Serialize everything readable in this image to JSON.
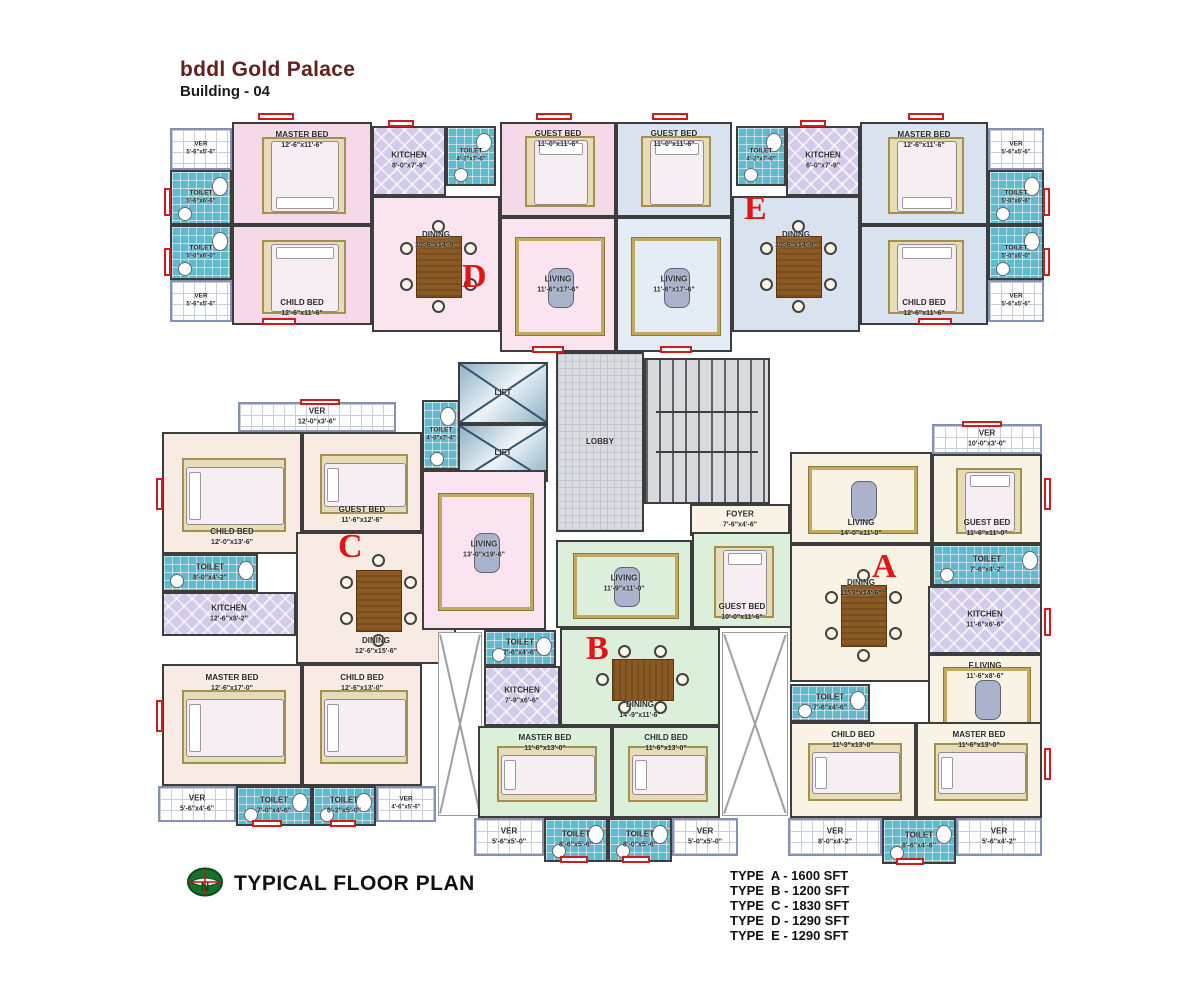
{
  "header": {
    "title": "bddl Gold Palace",
    "subtitle": "Building - 04"
  },
  "footer": {
    "plan_label": "TYPICAL FLOOR PLAN",
    "logo": "compass-north-icon",
    "types": [
      "TYPE  A - 1600 SFT",
      "TYPE  B - 1200 SFT",
      "TYPE  C - 1830 SFT",
      "TYPE  D - 1290 SFT",
      "TYPE  E - 1290 SFT"
    ]
  },
  "colors": {
    "unit_d": "#f6d9e9",
    "unit_e": "#d9e3ef",
    "unit_b": "#dcefdb",
    "unit_a": "#f8f3e4",
    "unit_c": "#f8ebe4",
    "toilet_tile": "#5fbac9",
    "kitchen_tile": "#d2cbe9",
    "letter_red": "#e01515",
    "title_maroon": "#63201c",
    "window_red": "#cf1d1d"
  },
  "unit_letters": [
    {
      "letter": "D",
      "x": 462,
      "y": 258
    },
    {
      "letter": "E",
      "x": 744,
      "y": 190
    },
    {
      "letter": "C",
      "x": 338,
      "y": 528
    },
    {
      "letter": "B",
      "x": 586,
      "y": 630
    },
    {
      "letter": "A",
      "x": 872,
      "y": 548
    }
  ],
  "rooms": [
    {
      "id": "ver-d-top",
      "type": "ver",
      "name": "VER",
      "dims": "5'-6\"x5'-6\"",
      "x": 170,
      "y": 128,
      "w": 62,
      "h": 42
    },
    {
      "id": "toilet-d-1",
      "type": "toilet",
      "name": "TOILET",
      "dims": "5'-6\"x6'-6\"",
      "x": 170,
      "y": 170,
      "w": 62,
      "h": 55,
      "furn": [
        "wc"
      ]
    },
    {
      "id": "toilet-d-2",
      "type": "toilet",
      "name": "TOILET",
      "dims": "5'-0\"x6'-0\"",
      "x": 170,
      "y": 225,
      "w": 62,
      "h": 55,
      "furn": [
        "wc"
      ]
    },
    {
      "id": "ver-d-bot",
      "type": "ver",
      "name": "VER",
      "dims": "5'-6\"x5'-6\"",
      "x": 170,
      "y": 280,
      "w": 62,
      "h": 42
    },
    {
      "id": "master-bed-d",
      "type": "pink",
      "name": "MASTER BED",
      "dims": "12'-6\"x11'-6\"",
      "x": 232,
      "y": 122,
      "w": 140,
      "h": 103,
      "lp": "t",
      "furn": [
        "bed-s"
      ]
    },
    {
      "id": "child-bed-d",
      "type": "pink",
      "name": "CHILD BED",
      "dims": "12'-6\"x11'-6\"",
      "x": 232,
      "y": 225,
      "w": 140,
      "h": 100,
      "lp": "b",
      "furn": [
        "bed-n"
      ]
    },
    {
      "id": "kitchen-d",
      "type": "kitchen",
      "name": "KITCHEN",
      "dims": "8'-0\"x7'-9\"",
      "x": 372,
      "y": 126,
      "w": 74,
      "h": 70
    },
    {
      "id": "toilet-d-3",
      "type": "toilet",
      "name": "TOILET",
      "dims": "4'-2\"x7'-6\"",
      "x": 446,
      "y": 126,
      "w": 50,
      "h": 60,
      "furn": [
        "wc"
      ]
    },
    {
      "id": "dining-d",
      "type": "pinklight",
      "name": "DINING",
      "dims": "10'-6\"x14'-9\"",
      "x": 372,
      "y": 196,
      "w": 128,
      "h": 136,
      "lp": "t2",
      "furn": [
        "table-v"
      ]
    },
    {
      "id": "guest-bed-d",
      "type": "pink",
      "name": "GUEST BED",
      "dims": "11'-0\"x11'-6\"",
      "x": 500,
      "y": 122,
      "w": 116,
      "h": 95,
      "lp": "t",
      "furn": [
        "bed-n"
      ]
    },
    {
      "id": "living-d",
      "type": "pinklight",
      "name": "LIVING",
      "dims": "11'-6\"x17'-6\"",
      "x": 500,
      "y": 217,
      "w": 116,
      "h": 135,
      "furn": [
        "rug"
      ]
    },
    {
      "id": "guest-bed-e",
      "type": "blue",
      "name": "GUEST BED",
      "dims": "11'-0\"x11'-6\"",
      "x": 616,
      "y": 122,
      "w": 116,
      "h": 95,
      "lp": "t",
      "furn": [
        "bed-n"
      ]
    },
    {
      "id": "living-e",
      "type": "bluelight",
      "name": "LIVING",
      "dims": "11'-6\"x17'-6\"",
      "x": 616,
      "y": 217,
      "w": 116,
      "h": 135,
      "furn": [
        "rug"
      ]
    },
    {
      "id": "toilet-e-3",
      "type": "toilet",
      "name": "TOILET",
      "dims": "4'-2\"x7'-6\"",
      "x": 736,
      "y": 126,
      "w": 50,
      "h": 60,
      "furn": [
        "wc"
      ]
    },
    {
      "id": "kitchen-e",
      "type": "kitchen",
      "name": "KITCHEN",
      "dims": "6'-0\"x7'-9\"",
      "x": 786,
      "y": 126,
      "w": 74,
      "h": 70
    },
    {
      "id": "dining-e",
      "type": "blue",
      "name": "DINING",
      "dims": "10'-6\"x14'-9\"",
      "x": 732,
      "y": 196,
      "w": 128,
      "h": 136,
      "lp": "t2",
      "furn": [
        "table-v"
      ]
    },
    {
      "id": "master-bed-e",
      "type": "blue",
      "name": "MASTER BED",
      "dims": "12'-6\"x11'-6\"",
      "x": 860,
      "y": 122,
      "w": 128,
      "h": 103,
      "lp": "t",
      "furn": [
        "bed-s"
      ]
    },
    {
      "id": "child-bed-e",
      "type": "blue",
      "name": "CHILD BED",
      "dims": "12'-6\"x11'-6\"",
      "x": 860,
      "y": 225,
      "w": 128,
      "h": 100,
      "lp": "b",
      "furn": [
        "bed-n"
      ]
    },
    {
      "id": "ver-e-top",
      "type": "ver",
      "name": "VER",
      "dims": "5'-6\"x5'-6\"",
      "x": 988,
      "y": 128,
      "w": 56,
      "h": 42
    },
    {
      "id": "toilet-e-1",
      "type": "toilet",
      "name": "TOILET",
      "dims": "5'-0\"x6'-6\"",
      "x": 988,
      "y": 170,
      "w": 56,
      "h": 55,
      "furn": [
        "wc"
      ]
    },
    {
      "id": "toilet-e-2",
      "type": "toilet",
      "name": "TOILET",
      "dims": "5'-0\"x6'-0\"",
      "x": 988,
      "y": 225,
      "w": 56,
      "h": 55,
      "furn": [
        "wc"
      ]
    },
    {
      "id": "ver-e-bot",
      "type": "ver",
      "name": "VER",
      "dims": "5'-6\"x5'-6\"",
      "x": 988,
      "y": 280,
      "w": 56,
      "h": 42
    },
    {
      "id": "lift-1",
      "type": "lift",
      "name": "LIFT",
      "x": 458,
      "y": 362,
      "w": 90,
      "h": 62,
      "furn": [
        "xcross"
      ]
    },
    {
      "id": "lift-2",
      "type": "lift",
      "name": "LIFT",
      "x": 458,
      "y": 424,
      "w": 90,
      "h": 58,
      "furn": [
        "xcross"
      ]
    },
    {
      "id": "toilet-core",
      "type": "toilet",
      "name": "TOILET",
      "dims": "4'-0\"x7'-4\"",
      "x": 422,
      "y": 400,
      "w": 38,
      "h": 70,
      "furn": [
        "wc"
      ]
    },
    {
      "id": "lobby",
      "type": "lobby",
      "name": "LOBBY",
      "x": 556,
      "y": 352,
      "w": 88,
      "h": 180
    },
    {
      "id": "stairs",
      "type": "stairs",
      "x": 644,
      "y": 358,
      "w": 126,
      "h": 146,
      "furn": [
        "rails"
      ]
    },
    {
      "id": "foyer",
      "type": "cream",
      "name": "FOYER",
      "dims": "7'-6\"x4'-6\"",
      "x": 690,
      "y": 504,
      "w": 100,
      "h": 32
    },
    {
      "id": "ver-c-top",
      "type": "ver",
      "name": "VER",
      "dims": "12'-0\"x3'-6\"",
      "x": 238,
      "y": 402,
      "w": 158,
      "h": 30
    },
    {
      "id": "child-bed-c1",
      "type": "creamc",
      "name": "CHILD BED",
      "dims": "12'-0\"x13'-6\"",
      "x": 162,
      "y": 432,
      "w": 140,
      "h": 122,
      "lp": "b",
      "furn": [
        "bed-w"
      ]
    },
    {
      "id": "guest-bed-c",
      "type": "creamc",
      "name": "GUEST BED",
      "dims": "11'-6\"x12'-6\"",
      "x": 302,
      "y": 432,
      "w": 120,
      "h": 100,
      "lp": "b",
      "furn": [
        "bed-w"
      ]
    },
    {
      "id": "toilet-c-1",
      "type": "toilet",
      "name": "TOILET",
      "dims": "8'-0\"x4'-2\"",
      "x": 162,
      "y": 554,
      "w": 96,
      "h": 38,
      "furn": [
        "wc"
      ]
    },
    {
      "id": "kitchen-c",
      "type": "kitchen",
      "name": "KITCHEN",
      "dims": "12'-6\"x8'-2\"",
      "x": 162,
      "y": 592,
      "w": 134,
      "h": 44
    },
    {
      "id": "dining-c",
      "type": "creamc",
      "name": "DINING",
      "dims": "12'-6\"x15'-6\"",
      "x": 296,
      "y": 532,
      "w": 160,
      "h": 132,
      "lp": "b",
      "furn": [
        "table-v"
      ]
    },
    {
      "id": "living-c",
      "type": "pinklight",
      "name": "LIVING",
      "dims": "13'-0\"x19'-6\"",
      "x": 422,
      "y": 470,
      "w": 124,
      "h": 160,
      "furn": [
        "rug"
      ]
    },
    {
      "id": "master-bed-c",
      "type": "creamc",
      "name": "MASTER BED",
      "dims": "12'-6\"x17'-0\"",
      "x": 162,
      "y": 664,
      "w": 140,
      "h": 122,
      "lp": "t",
      "furn": [
        "bed-w"
      ]
    },
    {
      "id": "child-bed-c2",
      "type": "creamc",
      "name": "CHILD BED",
      "dims": "12'-6\"x13'-0\"",
      "x": 302,
      "y": 664,
      "w": 120,
      "h": 122,
      "lp": "t",
      "furn": [
        "bed-w"
      ]
    },
    {
      "id": "ver-c-b1",
      "type": "ver",
      "name": "VER",
      "dims": "5'-6\"x4'-6\"",
      "x": 158,
      "y": 786,
      "w": 78,
      "h": 36
    },
    {
      "id": "toilet-c-b1",
      "type": "toilet",
      "name": "TOILET",
      "dims": "7'-0\"x4'-6\"",
      "x": 236,
      "y": 786,
      "w": 76,
      "h": 40,
      "furn": [
        "wc"
      ]
    },
    {
      "id": "toilet-c-b2",
      "type": "toilet",
      "name": "TOILET",
      "dims": "6'-2\"x5'-0\"",
      "x": 312,
      "y": 786,
      "w": 64,
      "h": 40,
      "furn": [
        "wc"
      ]
    },
    {
      "id": "ver-c-b2",
      "type": "ver",
      "name": "VER",
      "dims": "4'-6\"x5'-6\"",
      "x": 376,
      "y": 786,
      "w": 60,
      "h": 36
    },
    {
      "id": "duct-l",
      "type": "duct",
      "x": 438,
      "y": 632,
      "w": 44,
      "h": 184,
      "furn": [
        "xgray"
      ]
    },
    {
      "id": "duct-r",
      "type": "duct",
      "x": 722,
      "y": 632,
      "w": 66,
      "h": 184,
      "furn": [
        "xgray"
      ]
    },
    {
      "id": "living-b",
      "type": "green",
      "name": "LIVING",
      "dims": "11'-9\"x11'-0\"",
      "x": 556,
      "y": 540,
      "w": 136,
      "h": 88,
      "furn": [
        "rug"
      ]
    },
    {
      "id": "guest-bed-b",
      "type": "green",
      "name": "GUEST BED",
      "dims": "10'-0\"x11'-6\"",
      "x": 692,
      "y": 532,
      "w": 100,
      "h": 96,
      "lp": "b",
      "furn": [
        "bed-n"
      ]
    },
    {
      "id": "toilet-b",
      "type": "toilet",
      "name": "TOILET",
      "dims": "7'-6\"x4'-6\"",
      "x": 484,
      "y": 630,
      "w": 72,
      "h": 36,
      "furn": [
        "wc"
      ]
    },
    {
      "id": "kitchen-b",
      "type": "kitchen",
      "name": "KITCHEN",
      "dims": "7'-9\"x6'-6\"",
      "x": 484,
      "y": 666,
      "w": 76,
      "h": 60
    },
    {
      "id": "dining-b",
      "type": "green",
      "name": "DINING",
      "dims": "14'-9\"x11'-6\"",
      "x": 560,
      "y": 628,
      "w": 160,
      "h": 98,
      "lp": "b",
      "furn": [
        "table-h"
      ]
    },
    {
      "id": "master-bed-b",
      "type": "green",
      "name": "MASTER BED",
      "dims": "11'-6\"x13'-0\"",
      "x": 478,
      "y": 726,
      "w": 134,
      "h": 92,
      "lp": "t",
      "furn": [
        "bed-w"
      ]
    },
    {
      "id": "child-bed-b",
      "type": "green",
      "name": "CHILD BED",
      "dims": "11'-6\"x13'-0\"",
      "x": 612,
      "y": 726,
      "w": 108,
      "h": 92,
      "lp": "t",
      "furn": [
        "bed-w"
      ]
    },
    {
      "id": "ver-b-1",
      "type": "ver",
      "name": "VER",
      "dims": "5'-6\"x5'-0\"",
      "x": 474,
      "y": 818,
      "w": 70,
      "h": 38
    },
    {
      "id": "toilet-b-1",
      "type": "toilet",
      "name": "TOILET",
      "dims": "8'-6\"x5'-6\"",
      "x": 544,
      "y": 818,
      "w": 64,
      "h": 44,
      "furn": [
        "wc"
      ]
    },
    {
      "id": "toilet-b-2",
      "type": "toilet",
      "name": "TOILET",
      "dims": "8'-0\"x5'-6\"",
      "x": 608,
      "y": 818,
      "w": 64,
      "h": 44,
      "furn": [
        "wc"
      ]
    },
    {
      "id": "ver-b-2",
      "type": "ver",
      "name": "VER",
      "dims": "5'-0\"x5'-0\"",
      "x": 672,
      "y": 818,
      "w": 66,
      "h": 38
    },
    {
      "id": "living-a",
      "type": "cream",
      "name": "LIVING",
      "dims": "14'-0\"x11'-0\"",
      "x": 790,
      "y": 452,
      "w": 142,
      "h": 92,
      "lp": "b",
      "furn": [
        "rug"
      ]
    },
    {
      "id": "ver-a-top",
      "type": "ver",
      "name": "VER",
      "dims": "10'-0\"x3'-0\"",
      "x": 932,
      "y": 424,
      "w": 110,
      "h": 30
    },
    {
      "id": "guest-bed-a",
      "type": "cream",
      "name": "GUEST BED",
      "dims": "11'-6\"x11'-0\"",
      "x": 932,
      "y": 454,
      "w": 110,
      "h": 90,
      "lp": "b",
      "furn": [
        "bed-n"
      ]
    },
    {
      "id": "dining-a",
      "type": "cream",
      "name": "DINING",
      "dims": "11'-3\"x14'-6\"",
      "x": 790,
      "y": 544,
      "w": 142,
      "h": 138,
      "lp": "t2",
      "furn": [
        "table-v"
      ]
    },
    {
      "id": "toilet-a-1",
      "type": "toilet",
      "name": "TOILET",
      "dims": "7'-6\"x4'-2\"",
      "x": 932,
      "y": 544,
      "w": 110,
      "h": 42,
      "furn": [
        "wc"
      ]
    },
    {
      "id": "kitchen-a",
      "type": "kitchen",
      "name": "KITCHEN",
      "dims": "11'-6\"x6'-6\"",
      "x": 928,
      "y": 586,
      "w": 114,
      "h": 68
    },
    {
      "id": "f-living-a",
      "type": "cream",
      "name": "F.LIVING",
      "dims": "11'-6\"x8'-6\"",
      "x": 928,
      "y": 654,
      "w": 114,
      "h": 86,
      "lp": "t",
      "furn": [
        "rug"
      ]
    },
    {
      "id": "toilet-a-2",
      "type": "toilet",
      "name": "TOILET",
      "dims": "7'-6\"x4'-6\"",
      "x": 790,
      "y": 684,
      "w": 80,
      "h": 38,
      "furn": [
        "wc"
      ]
    },
    {
      "id": "child-bed-a",
      "type": "cream",
      "name": "CHILD BED",
      "dims": "11'-3\"x13'-0\"",
      "x": 790,
      "y": 722,
      "w": 126,
      "h": 96,
      "lp": "t",
      "furn": [
        "bed-w"
      ]
    },
    {
      "id": "master-bed-a",
      "type": "cream",
      "name": "MASTER BED",
      "dims": "11'-6\"x13'-0\"",
      "x": 916,
      "y": 722,
      "w": 126,
      "h": 96,
      "lp": "t",
      "furn": [
        "bed-w"
      ]
    },
    {
      "id": "ver-a-b1",
      "type": "ver",
      "name": "VER",
      "dims": "8'-0\"x4'-2\"",
      "x": 788,
      "y": 818,
      "w": 94,
      "h": 38
    },
    {
      "id": "toilet-a-b",
      "type": "toilet",
      "name": "TOILET",
      "dims": "8'-6\"x4'-6\"",
      "x": 882,
      "y": 818,
      "w": 74,
      "h": 46,
      "furn": [
        "wc"
      ]
    },
    {
      "id": "ver-a-b2",
      "type": "ver",
      "name": "VER",
      "dims": "5'-6\"x4'-2\"",
      "x": 956,
      "y": 818,
      "w": 86,
      "h": 38
    }
  ],
  "windows": [
    {
      "x": 258,
      "y": 113,
      "w": 36,
      "h": 7
    },
    {
      "x": 536,
      "y": 113,
      "w": 36,
      "h": 7
    },
    {
      "x": 652,
      "y": 113,
      "w": 36,
      "h": 7
    },
    {
      "x": 908,
      "y": 113,
      "w": 36,
      "h": 7
    },
    {
      "x": 388,
      "y": 120,
      "w": 26,
      "h": 7
    },
    {
      "x": 800,
      "y": 120,
      "w": 26,
      "h": 7
    },
    {
      "x": 164,
      "y": 188,
      "w": 7,
      "h": 28
    },
    {
      "x": 164,
      "y": 248,
      "w": 7,
      "h": 28
    },
    {
      "x": 1043,
      "y": 188,
      "w": 7,
      "h": 28
    },
    {
      "x": 1043,
      "y": 248,
      "w": 7,
      "h": 28
    },
    {
      "x": 262,
      "y": 318,
      "w": 34,
      "h": 7
    },
    {
      "x": 918,
      "y": 318,
      "w": 34,
      "h": 7
    },
    {
      "x": 532,
      "y": 346,
      "w": 32,
      "h": 7
    },
    {
      "x": 660,
      "y": 346,
      "w": 32,
      "h": 7
    },
    {
      "x": 156,
      "y": 478,
      "w": 7,
      "h": 32
    },
    {
      "x": 156,
      "y": 700,
      "w": 7,
      "h": 32
    },
    {
      "x": 252,
      "y": 820,
      "w": 30,
      "h": 7
    },
    {
      "x": 330,
      "y": 820,
      "w": 26,
      "h": 7
    },
    {
      "x": 560,
      "y": 856,
      "w": 28,
      "h": 7
    },
    {
      "x": 622,
      "y": 856,
      "w": 28,
      "h": 7
    },
    {
      "x": 896,
      "y": 858,
      "w": 28,
      "h": 7
    },
    {
      "x": 1044,
      "y": 478,
      "w": 7,
      "h": 32
    },
    {
      "x": 1044,
      "y": 608,
      "w": 7,
      "h": 28
    },
    {
      "x": 1044,
      "y": 748,
      "w": 7,
      "h": 32
    },
    {
      "x": 300,
      "y": 399,
      "w": 40,
      "h": 6
    },
    {
      "x": 962,
      "y": 421,
      "w": 40,
      "h": 6
    }
  ]
}
